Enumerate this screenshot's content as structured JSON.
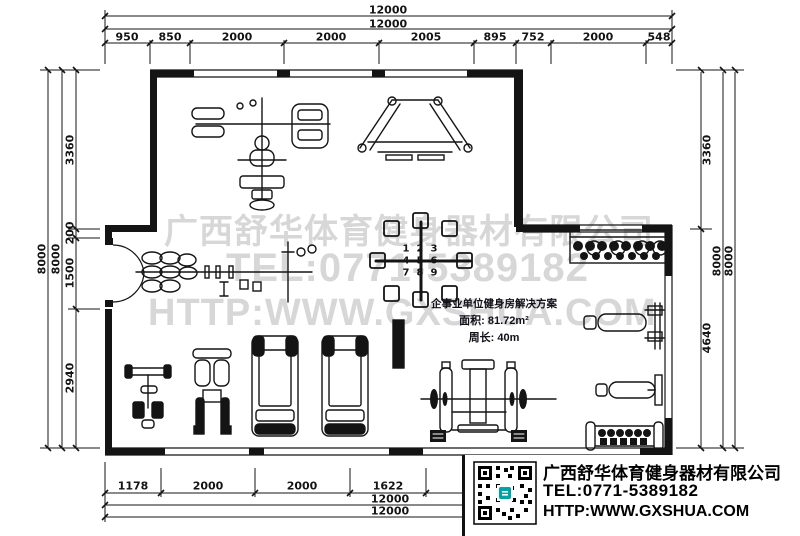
{
  "colors": {
    "line": "#141414",
    "watermark": "#d7d7d7",
    "accent_teal": "#00a2a2",
    "paper": "#ffffff"
  },
  "watermark": {
    "company": "广西舒华体育健身器材有限公司",
    "tel": "TEL:0771-5389182",
    "website": "HTTP:WWW.GXSHUA.COM"
  },
  "solution_box": {
    "title": "企事业单位健身房解决方案",
    "area": "面积: 81.72m²",
    "perimeter": "周长: 40m"
  },
  "logo_box": {
    "company": "广西舒华体育健身器材有限公司",
    "tel": "TEL:0771-5389182",
    "website": "HTTP:WWW.GXSHUA.COM"
  },
  "multi_gym_stations": [
    "1",
    "2",
    "3",
    "4",
    "5",
    "6",
    "7",
    "8",
    "9"
  ],
  "dims": {
    "top": {
      "total_outer": "12000",
      "total_inner": "12000",
      "segments": [
        "950",
        "850",
        "2000",
        "2000",
        "2005",
        "895",
        "752",
        "2000",
        "548"
      ]
    },
    "bottom": {
      "segments": [
        "1178",
        "2000",
        "2000",
        "1622"
      ],
      "total_inner": "12000",
      "total_outer": "12000"
    },
    "left": {
      "total_outer": "8000",
      "total_inner": "8000",
      "segments": [
        "3360",
        "200",
        "1500",
        "2940"
      ]
    },
    "right": {
      "segments": [
        "3360",
        "4640"
      ],
      "total_inner": "8000",
      "total_outer": "8000"
    }
  }
}
